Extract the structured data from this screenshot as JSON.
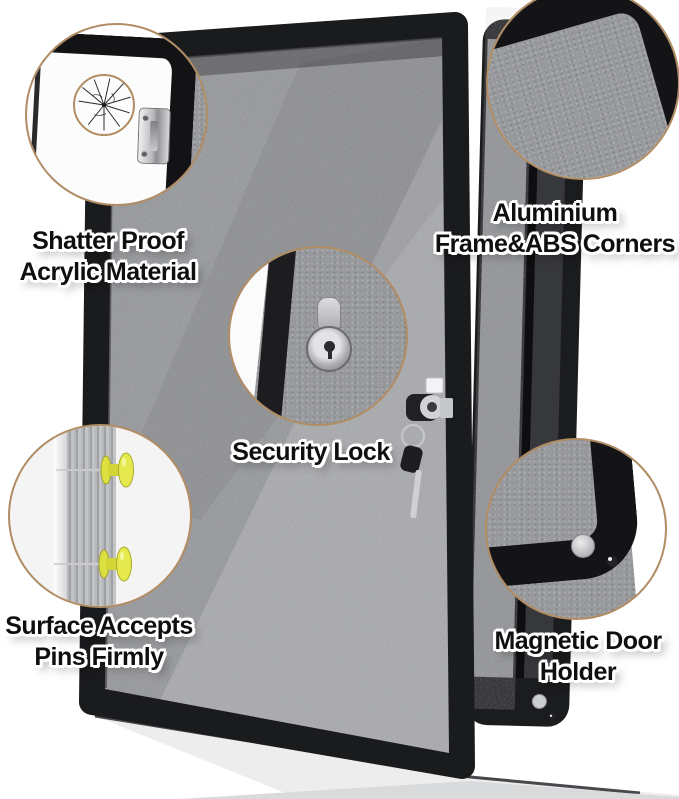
{
  "colors": {
    "background": "#ffffff",
    "callout_ring": "#b28c63",
    "frame_black": "#1a1b1d",
    "felt_gray": "#8d8f92",
    "pin_yellow": "#e4e748",
    "magnet_silver": "#cdced0",
    "label_text": "#0f0f10",
    "label_outline": "#ffffff"
  },
  "callouts": [
    {
      "id": "shatter-proof",
      "lines": [
        "Shatter Proof",
        "Acrylic Material"
      ]
    },
    {
      "id": "aluminium-corners",
      "lines": [
        "Aluminium",
        "Frame&ABS Corners"
      ]
    },
    {
      "id": "security-lock",
      "lines": [
        "Security Lock"
      ]
    },
    {
      "id": "pin-surface",
      "lines": [
        "Surface Accepts",
        "Pins Firmly"
      ]
    },
    {
      "id": "magnetic-door-holder",
      "lines": [
        "Magnetic Door",
        "Holder"
      ]
    }
  ]
}
